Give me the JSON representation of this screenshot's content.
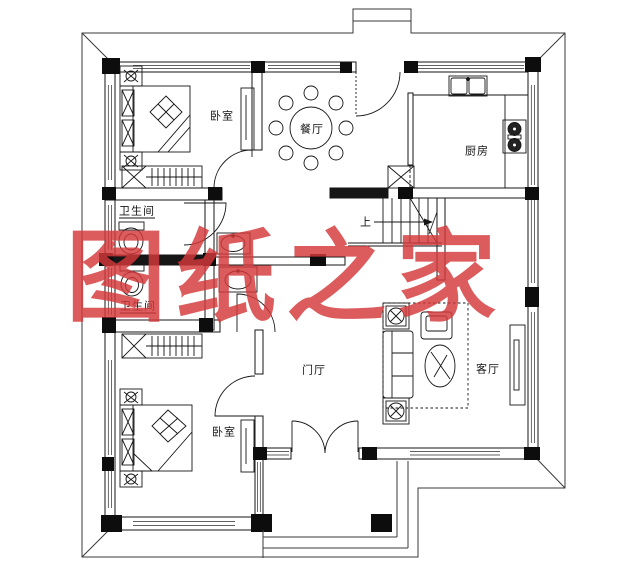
{
  "title": "二层别墅一层户型图",
  "watermark": {
    "text": "图纸之家",
    "color": "#d5383a"
  },
  "labels": {
    "bedroom_top": "卧室",
    "dining": "餐厅",
    "kitchen": "厨房",
    "bath_upper": "卫生间",
    "bath_lower": "卫生间",
    "stairs_up": "上",
    "foyer": "门厅",
    "living": "客厅",
    "bedroom_bottom": "卧室"
  },
  "colors": {
    "line": "#1a1a1a",
    "background": "#ffffff",
    "watermark": "#d5383a"
  }
}
